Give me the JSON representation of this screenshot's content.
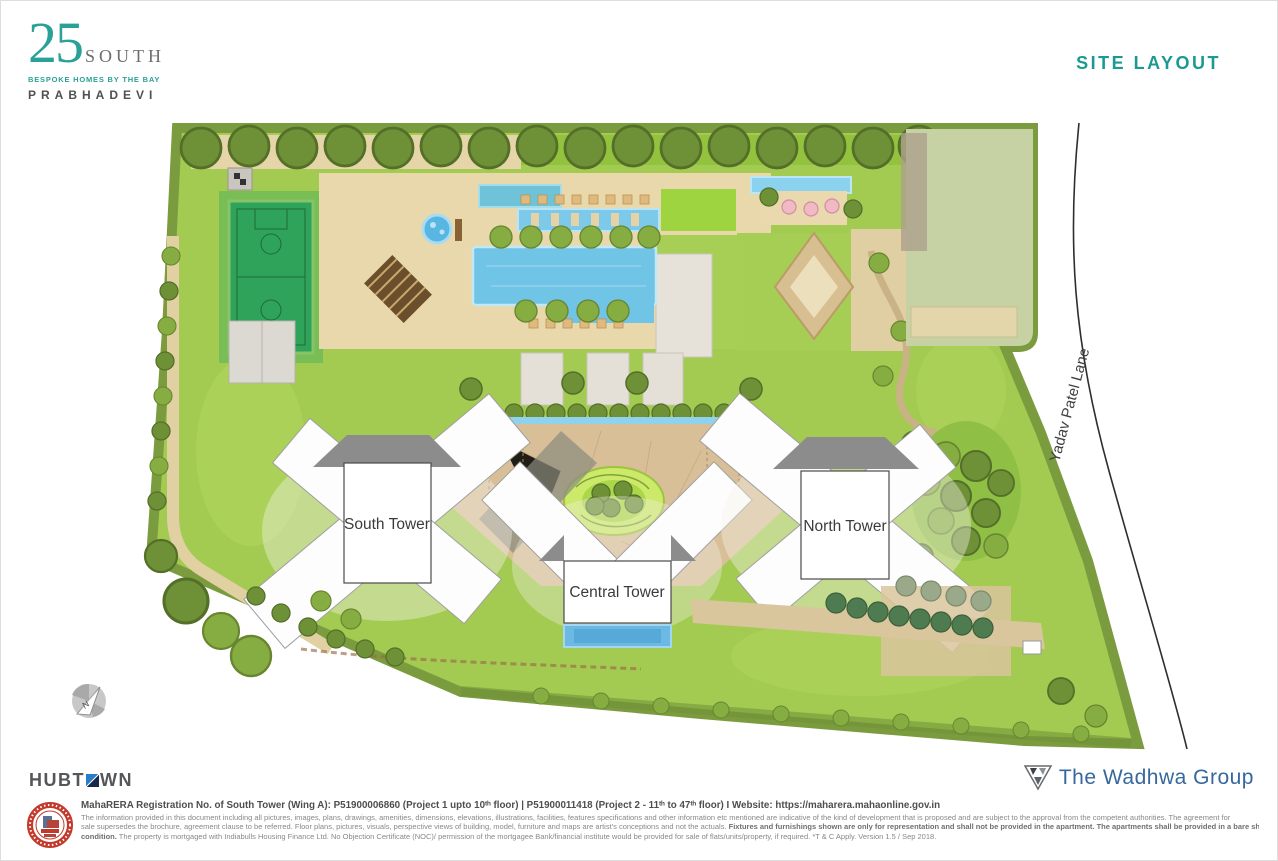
{
  "header": {
    "logo": {
      "number": "25",
      "name": "SOUTH",
      "tagline": "BESPOKE HOMES BY THE BAY",
      "location": "PRABHADEVI"
    },
    "page_title": "SITE LAYOUT"
  },
  "plan": {
    "towers": {
      "south": "South Tower",
      "central": "Central Tower",
      "north": "North Tower"
    },
    "road_label": "Yadav Patel Lane",
    "compass_label": "N"
  },
  "footer": {
    "hubtown_part1": "HUBT",
    "hubtown_part2": "WN",
    "rera_line": "MahaRERA Registration No. of South Tower (Wing A): P51900006860 (Project 1 upto 10ᵗʰ floor) | P51900011418 (Project 2 - 11ᵗʰ to 47ᵗʰ floor)  I Website: https://maharera.mahaonline.gov.in",
    "disclaimer_line1": "The information provided in this document including all pictures, images, plans, drawings, amenities, dimensions, elevations, illustrations, facilities, features specifications and other information etc mentioned are indicative of the kind of development that is proposed and are subject to the approval from the competent authorities. The agreement for",
    "disclaimer_line2_normal": "sale supersedes the brochure, agreement clause to be referred. Floor plans, pictures, visuals, perspective views of building, model, furniture and maps are artist's conceptions and not the actuals. ",
    "disclaimer_line2_bold": "Fixtures and furnishings shown are only for representation and shall not be provided in the apartment. The apartments shall be provided in a bare shell",
    "disclaimer_line3_bold": "condition.",
    "disclaimer_line3_normal": " The property is mortgaged with Indiabulls Housing Finance Ltd. No Objection Certificate (NOC)/ permission of the mortgagee Bank/financial institute would be provided for sale of flats/units/property, if required. *T & C Apply. Version 1.5 / Sep 2018.",
    "wadhwa": "The Wadhwa Group"
  },
  "colors": {
    "brand_teal": "#2aa198",
    "title_teal": "#1b9a91",
    "wadhwa_blue": "#36689d",
    "stamp_red": "#c23a2c",
    "grass_green": "#a3cb52",
    "pool_blue": "#70c4e6"
  }
}
